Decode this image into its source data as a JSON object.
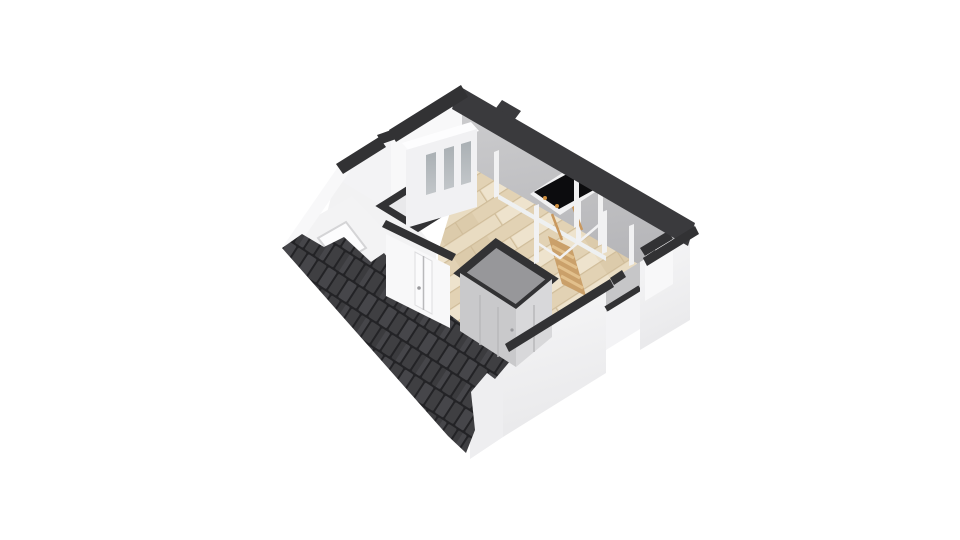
{
  "title": "3D floor plan - attic level, isometric view",
  "view": {
    "width": 960,
    "height": 540,
    "background": "#ffffff"
  },
  "palette": {
    "bg": "#ffffff",
    "cut-band": "#323234",
    "roof-cut-band": "#3a3a3d",
    "roof-tile": "#3f3f42",
    "roof-tile-alt": "#46464a",
    "roof-gap": "#232326",
    "slope-gray-light": "#cdcdcf",
    "slope-gray-dark": "#b5b5b8",
    "wall-ext-light": "#f7f7f8",
    "wall-ext-dark": "#e9e9eb",
    "inner-wall": "#f8f8f9",
    "inner-wall-2": "#f3f3f5",
    "room-fill": "#f2f2f3",
    "gable": "#eeeef0",
    "reveal": "#c6c6c8",
    "slope-white": "#f3f3f4",
    "skylight": "#fcfcfd",
    "skylight-frame": "#d4d4d6",
    "wood-a": "#e9dcc2",
    "wood-b": "#e2d2b4",
    "wood-line": "#d0bd9a",
    "glass-light": "#c2c6c9",
    "glass-dark": "#aab0b4",
    "cap": "#fdfdfe",
    "frame-face": "#f1f1f3",
    "rail": "#f1f1f2",
    "beam": "#eef0f1",
    "closet-front": "#d8d8da",
    "closet-side": "#c9c9cb",
    "stairwell": "#97979a",
    "seam": "#b9b9bb",
    "door": "#fbfbfc",
    "door-edge": "#dedee0",
    "handle": "#9a9a9d",
    "wc-floor": "#e9e9eb",
    "toilet": "#fdfdfe",
    "hatch": "#0c0c0e",
    "hinge": "#cf8f3f",
    "ladder": "#c9985e",
    "steps": "#caa06a",
    "step-light": "#e2c08c"
  },
  "scene": {
    "objects": [
      {
        "label": "tiled roof slope (south-west), dark charcoal tiles"
      },
      {
        "label": "interior roof slope (north-east), gray"
      },
      {
        "label": "exterior walls with dark section-cut bands"
      },
      {
        "label": "recessed notch in east exterior wall"
      },
      {
        "label": "wood plank floor, light oak"
      },
      {
        "label": "WC room with toilet (two-button cistern)"
      },
      {
        "label": "glazed interior partition, three gray panes"
      },
      {
        "label": "white interior door with handle"
      },
      {
        "label": "gray stairwell enclosure / closet with door seams"
      },
      {
        "label": "wooden loft ladder and steps"
      },
      {
        "label": "black roof hatch with white frame and hinges"
      },
      {
        "label": "white railing posts around stair opening"
      },
      {
        "label": "roof window / skylight on white slope"
      },
      {
        "label": "roof structure posts under gray slope"
      }
    ]
  }
}
